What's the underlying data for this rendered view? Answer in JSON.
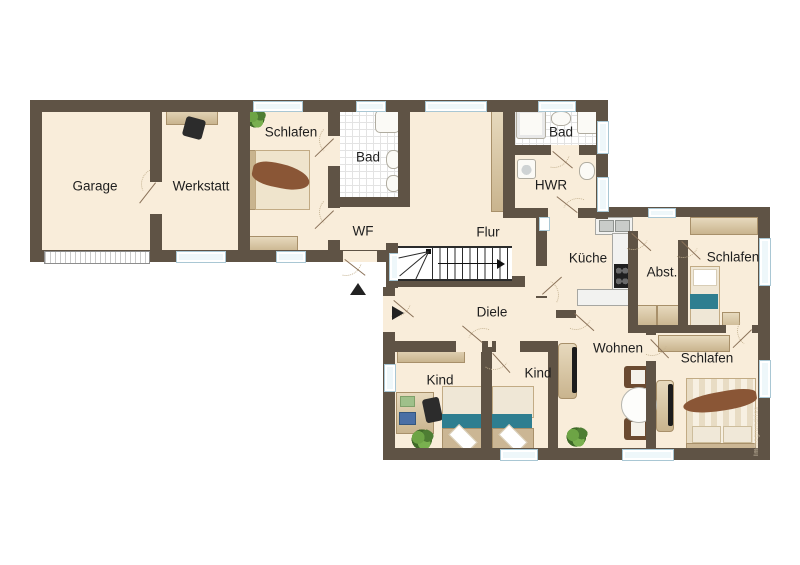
{
  "watermark": "Immogrundriss",
  "rooms": {
    "garage": {
      "label": "Garage"
    },
    "werkstatt": {
      "label": "Werkstatt"
    },
    "schlafen1": {
      "label": "Schlafen"
    },
    "bad1": {
      "label": "Bad"
    },
    "wf": {
      "label": "WF"
    },
    "flur": {
      "label": "Flur"
    },
    "bad2": {
      "label": "Bad"
    },
    "hwr": {
      "label": "HWR"
    },
    "kueche": {
      "label": "Küche"
    },
    "abst": {
      "label": "Abst."
    },
    "schlafen2": {
      "label": "Schlafen"
    },
    "diele": {
      "label": "Diele"
    },
    "wohnen": {
      "label": "Wohnen"
    },
    "kind1": {
      "label": "Kind"
    },
    "kind2": {
      "label": "Kind"
    },
    "schlafen3": {
      "label": "Schlafen"
    }
  },
  "colors": {
    "wall": "#5f5345",
    "floor": "#f9edda",
    "tile": "#ffffff",
    "tilegrid": "#e3e3e3",
    "window": "#eef7fa",
    "winframe": "#a9c7d4",
    "beige": "#d9c5a0",
    "beige2": "#cbb58c",
    "brown": "#8a5636",
    "teal": "#2e7e90",
    "white": "#fbfaf6",
    "dark": "#2c2c2c",
    "label": "#1e1e1e",
    "leaf": "#8a7158",
    "arc": "#c4b291",
    "plant": "#5f9140"
  }
}
